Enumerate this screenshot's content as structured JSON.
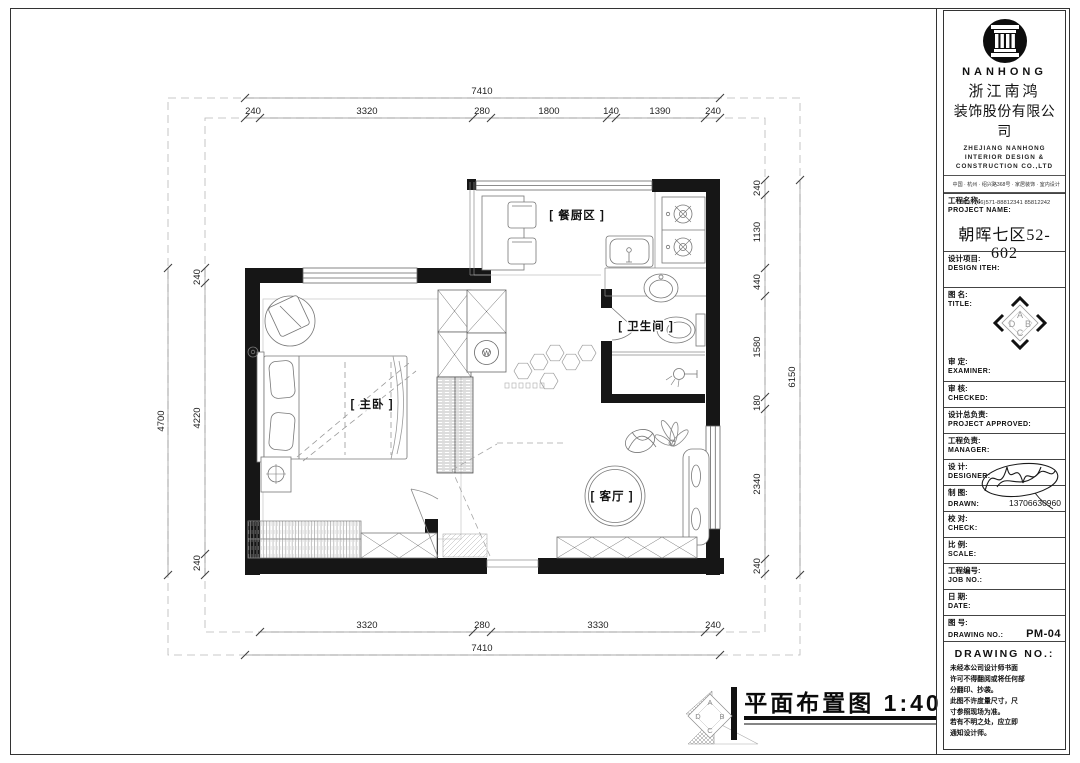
{
  "company": {
    "logo_text": "NANHONG",
    "name_zh_1": "浙江南鸿",
    "name_zh_2": "装饰股份有限公司",
    "name_en_1": "ZHEJIANG NANHONG",
    "name_en_2": "INTERIOR DESIGN &",
    "name_en_3": "CONSTRUCTION CO.,LTD",
    "address": "中国 · 杭州 · 绍兴路368号 · 家居装饰 · 室内设计",
    "tel": "TEL：(86)571-88812341  85812242"
  },
  "titleblock": {
    "project_label_zh": "工程名称:",
    "project_label_en": "PROJECT NAME:",
    "project_value": "朝晖七区52-602",
    "design_item_zh": "设计项目:",
    "design_item_en": "DESIGN ITEH:",
    "title_zh": "图  名:",
    "title_en": "TITLE:",
    "diamond_letters": [
      "A",
      "B",
      "C",
      "D"
    ],
    "rows": [
      {
        "zh": "审    定:",
        "en": "EXAMINER:",
        "value": ""
      },
      {
        "zh": "审    核:",
        "en": "CHECKED:",
        "value": ""
      },
      {
        "zh": "设计总负责:",
        "en": "PROJECT APPROVED:",
        "value": ""
      },
      {
        "zh": "工程负责:",
        "en": "MANAGER:",
        "value": ""
      },
      {
        "zh": "设    计:",
        "en": "DESIGNER:",
        "value": ""
      },
      {
        "zh": "制    图:",
        "en": "DRAWN:",
        "value": "13706630960"
      },
      {
        "zh": "校    对:",
        "en": "CHECK:",
        "value": ""
      },
      {
        "zh": "比    例:",
        "en": "SCALE:",
        "value": ""
      },
      {
        "zh": "工程编号:",
        "en": "JOB  NO.:",
        "value": ""
      },
      {
        "zh": "日    期:",
        "en": "DATE:",
        "value": ""
      },
      {
        "zh": "图    号:",
        "en": "DRAWING NO.:",
        "value": "PM-04"
      }
    ],
    "footer_header": "DRAWING NO.:",
    "notes": [
      "未经本公司设计师书面",
      "许可不得翻阅或将任何部",
      "分翻印、抄袭。",
      "此图不许度量尺寸，尺",
      "寸参照现场为准。",
      "若有不明之处，应立即",
      "通知设计师。"
    ]
  },
  "plan": {
    "rooms": {
      "kitchen_dining": "[ 餐厨区 ]",
      "bathroom": "[ 卫生间 ]",
      "master_bedroom": "[ 主卧 ]",
      "living_room": "[ 客厅 ]"
    },
    "symbols": {
      "washing_machine": "W"
    },
    "footer": {
      "figure_title": "平面布置图 1:40"
    },
    "dims": {
      "top_overall": "7410",
      "top_chain": [
        "240",
        "3320",
        "280",
        "1800",
        "140",
        "1390",
        "240"
      ],
      "bottom_chain": [
        "3320",
        "280",
        "3330",
        "240"
      ],
      "bottom_overall": "7410",
      "left_overall": "4700",
      "left_chain": [
        "240",
        "4220",
        "240"
      ],
      "right_overall": "6150",
      "right_chain": [
        "240",
        "1130",
        "440",
        "1580",
        "180",
        "2340",
        "240"
      ]
    }
  }
}
